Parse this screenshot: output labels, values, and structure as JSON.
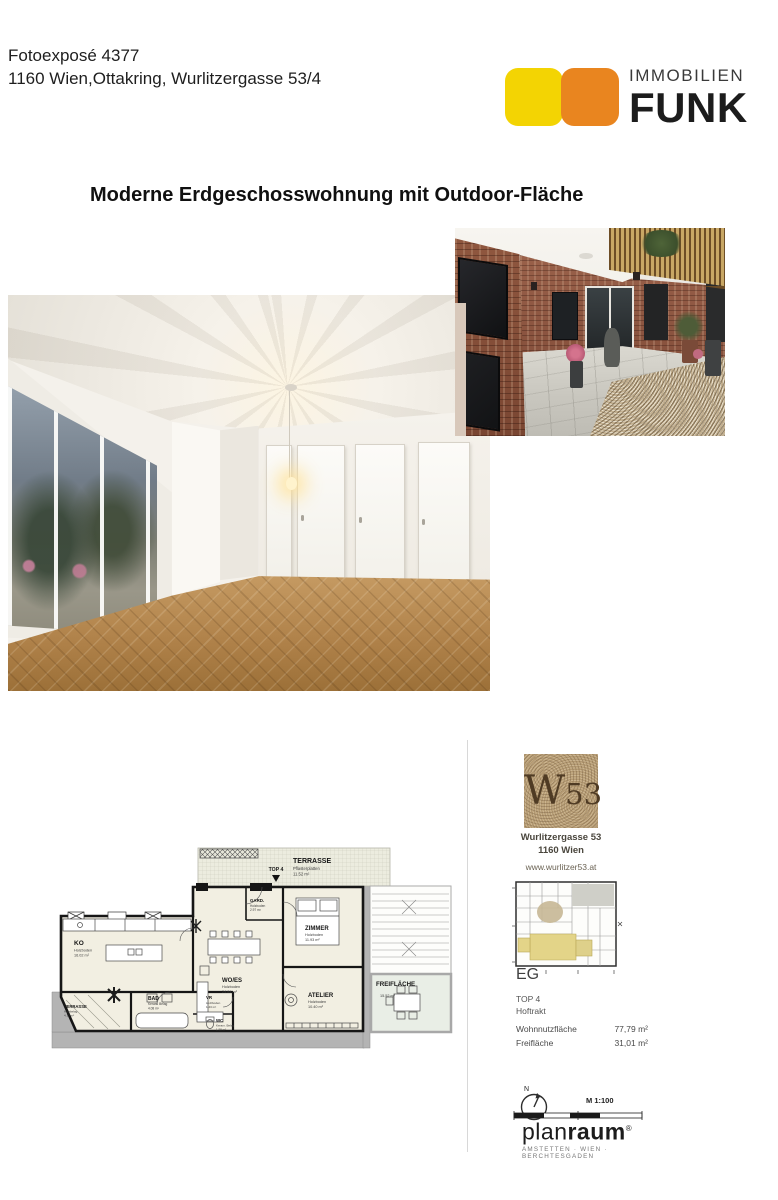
{
  "page": {
    "expose_number": "Fotoexposé 4377",
    "address_line": "1160 Wien,Ottakring, Wurlitzergasse 53/4",
    "title": "Moderne Erdgeschosswohnung mit Outdoor-Fläche"
  },
  "brand": {
    "line1": "IMMOBILIEN",
    "line2": "FUNK",
    "yellow": "#F3D403",
    "orange": "#E9851F"
  },
  "floorplan": {
    "top_marker": "TOP 4",
    "terrace_top": {
      "name": "TERRASSE",
      "floor": "Pflasterplatten",
      "area": "11.52 m²"
    },
    "rooms": {
      "ko": {
        "name": "KO",
        "floor": "Holzboden",
        "area": "16.02 m²"
      },
      "gard": {
        "name": "GARD.",
        "floor": "Holzboden",
        "area": "2.97 m²"
      },
      "zimmer": {
        "name": "ZIMMER",
        "floor": "Holzboden",
        "area": "11.93 m²"
      },
      "woes": {
        "name": "WO/ES",
        "floor": "Holzboden",
        "area": "24.84 m²"
      },
      "atelier": {
        "name": "ATELIER",
        "floor": "Holzboden",
        "area": "10.40 m²"
      },
      "bad": {
        "name": "BAD",
        "floor": "Keram. Belag",
        "area": "4.08 m²"
      },
      "vr": {
        "name": "VR",
        "floor": "Holzboden",
        "area": "1.43 m²"
      },
      "wc": {
        "name": "WC",
        "floor": "Keram. Belag",
        "area": "1.98 m²"
      },
      "terrasse_klein": {
        "name": "TERRASSE",
        "floor": "Holzbelag",
        "area": "4.17 m²"
      },
      "freiflaeche": {
        "name": "FREIFLÄCHE",
        "area": "15.52 m²"
      }
    }
  },
  "sidebar": {
    "logo_w": "W",
    "logo_53": "53",
    "address1": "Wurlitzergasse 53",
    "address2": "1160 Wien",
    "website": "www.wurlitzer53.at",
    "level": "EG",
    "unit": "TOP 4",
    "tract": "Hoftrakt",
    "metrics": [
      {
        "label": "Wohnnutzfläche",
        "value": "77,79 m²"
      },
      {
        "label": "Freifläche",
        "value": "31,01 m²"
      }
    ],
    "north": "N",
    "scale": "M 1:100",
    "planraum_plan": "plan",
    "planraum_raum": "raum",
    "planraum_reg": "®",
    "planraum_cities": "AMSTETTEN · WIEN · BERCHTESGADEN"
  }
}
